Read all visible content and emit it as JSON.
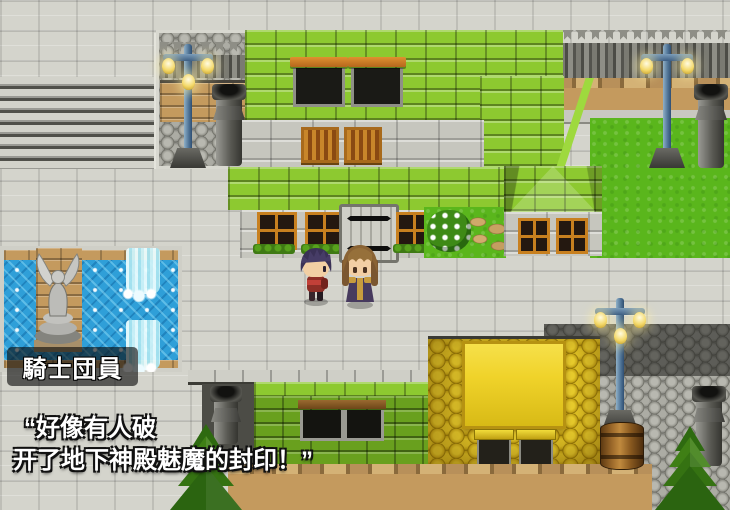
{
  "meta": {
    "width": 730,
    "height": 510,
    "scene": "town-square"
  },
  "dialog": {
    "speaker_name": "騎士団員",
    "line1": "“好像有人破",
    "line2": "开了地下神殿魅魔的封印！”"
  },
  "colors": {
    "pavement": "#d4d4cc",
    "stair_light": "#d2d2ca",
    "stair_dark": "#50504a",
    "lime_roof": "#8dc930",
    "dark_green_roof": "#69a01e",
    "stone_wall": "#c6c6be",
    "tan_brick": "#c49a5e",
    "grass": "#5ab61c",
    "water": "#2f9fd8",
    "gold_roof": "#c6a216",
    "gold_top": "#f0d32a",
    "cobble": "#8e8e86",
    "dark_cobble": "#4c4c46",
    "window_orange": "#c8801f",
    "lamp_glow": "#f6e49a",
    "dialog_text": "#ffffff",
    "label_bg": "rgba(10,10,10,0.62)"
  }
}
